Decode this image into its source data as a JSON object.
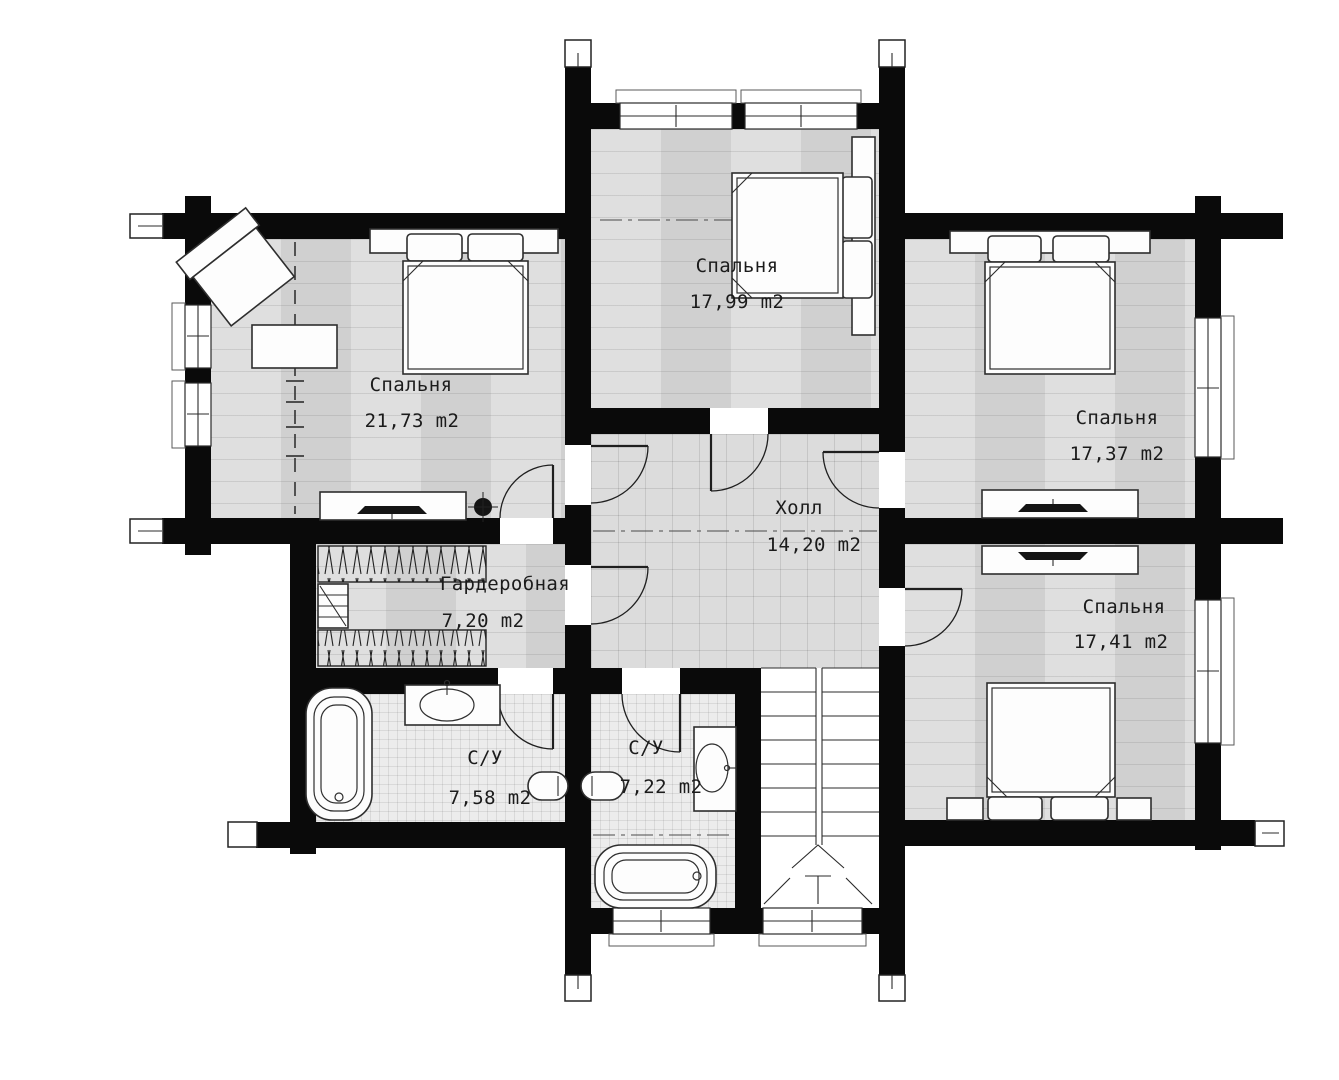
{
  "plan": {
    "rooms": [
      {
        "id": "bedroom-left",
        "name": "Спальня",
        "area": "21,73 m2"
      },
      {
        "id": "bedroom-top",
        "name": "Спальня",
        "area": "17,99 m2"
      },
      {
        "id": "bedroom-right-upper",
        "name": "Спальня",
        "area": "17,37 m2"
      },
      {
        "id": "bedroom-right-lower",
        "name": "Спальня",
        "area": "17,41 m2"
      },
      {
        "id": "hall",
        "name": "Холл",
        "area": "14,20 m2"
      },
      {
        "id": "wardrobe",
        "name": "Гардеробная",
        "area": "7,20 m2"
      },
      {
        "id": "bathroom-left",
        "name": "С/У",
        "area": "7,58 m2"
      },
      {
        "id": "bathroom-right",
        "name": "С/У",
        "area": "7,22 m2"
      }
    ],
    "colors": {
      "wall": "#0a0a0a",
      "floor_wood": "#d8d8d8",
      "floor_tile": "#dcdcdc",
      "floor_bath": "#ececec",
      "line": "#2e2e2e"
    }
  }
}
